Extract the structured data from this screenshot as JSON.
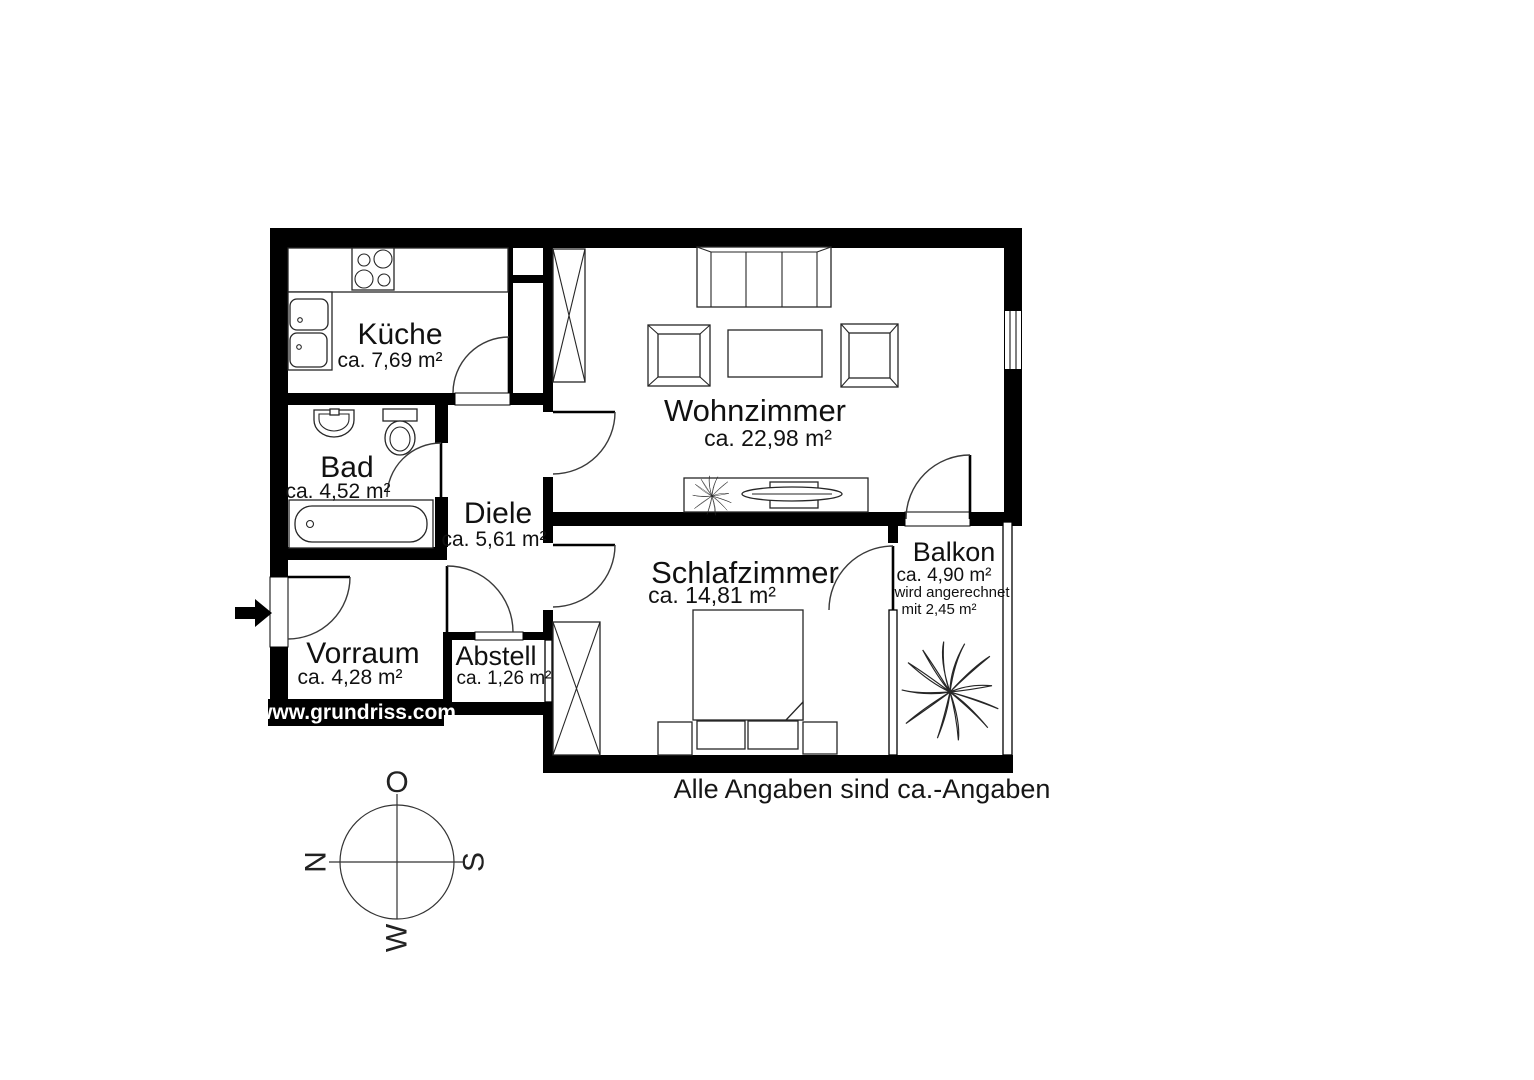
{
  "title_note": "Alle Angaben sind ca.-Angaben",
  "watermark": "www.grundriss.com",
  "rooms": {
    "kueche": {
      "name": "Küche",
      "area": "ca. 7,69 m²"
    },
    "bad": {
      "name": "Bad",
      "area": "ca. 4,52 m²"
    },
    "diele": {
      "name": "Diele",
      "area": "ca. 5,61 m²"
    },
    "vorraum": {
      "name": "Vorraum",
      "area": "ca. 4,28 m²"
    },
    "abstell": {
      "name": "Abstell",
      "area": "ca. 1,26 m²"
    },
    "wohnzimmer": {
      "name": "Wohnzimmer",
      "area": "ca. 22,98 m²"
    },
    "schlafzimmer": {
      "name": "Schlafzimmer",
      "area": "ca. 14,81 m²"
    },
    "balkon": {
      "name": "Balkon",
      "area": "ca. 4,90 m²",
      "note_line1": "wird angerechnet",
      "note_line2": "mit 2,45 m²"
    }
  },
  "compass": {
    "top": "O",
    "left": "N",
    "right": "S",
    "bottom": "W"
  },
  "colors": {
    "wall": "#000000",
    "furniture_line": "#222222",
    "text": "#111111"
  }
}
